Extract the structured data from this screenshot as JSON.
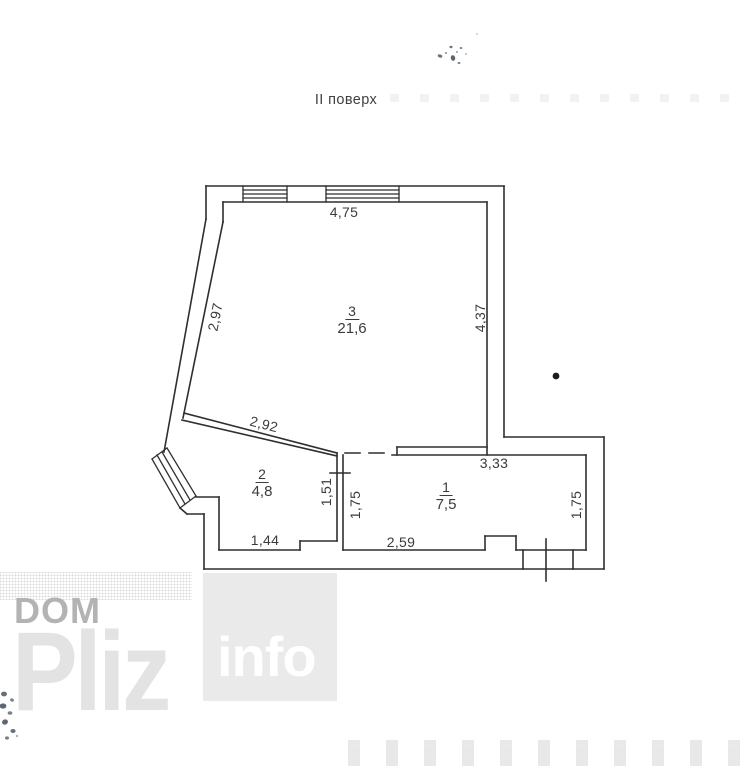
{
  "page": {
    "title": "II поверх"
  },
  "plan": {
    "rooms": [
      {
        "number": "3",
        "area": "21,6"
      },
      {
        "number": "2",
        "area": "4,8"
      },
      {
        "number": "1",
        "area": "7,5"
      }
    ],
    "dimensions": {
      "top_wall": "4,75",
      "left_wall": "2,97",
      "right_wall": "4,37",
      "hall_wall": "2,92",
      "room1_top": "3,33",
      "room2_right": "1,51",
      "room1_left": "1,75",
      "room1_right": "1,75",
      "room2_bottom": "1,44",
      "room1_bottom": "2,59"
    }
  },
  "watermark": {
    "word1": "DOM",
    "word2": "Pliz",
    "word3": "info"
  }
}
